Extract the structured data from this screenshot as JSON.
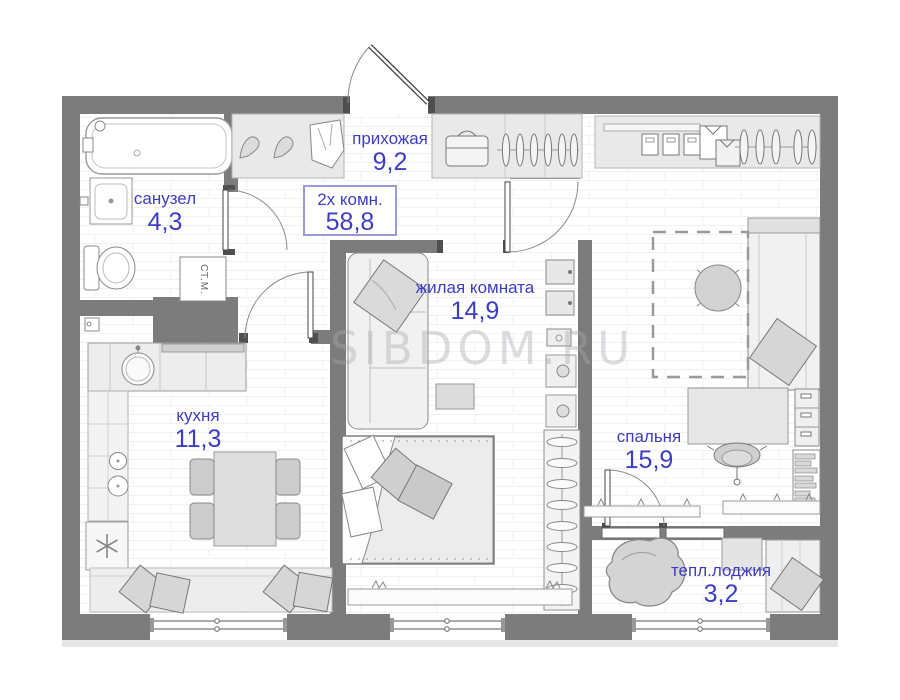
{
  "plan": {
    "type_label": "2х комн.",
    "total_area": "58,8",
    "watermark": "SIBDOM.RU",
    "rooms": [
      {
        "name": "прихожая",
        "area": "9,2"
      },
      {
        "name": "санузел",
        "area": "4,3"
      },
      {
        "name": "жилая комната",
        "area": "14,9"
      },
      {
        "name": "кухня",
        "area": "11,3"
      },
      {
        "name": "спальня",
        "area": "15,9"
      },
      {
        "name": "тепл.лоджия",
        "area": "3,2"
      }
    ],
    "appliance_labels": {
      "washing_machine": "СТ.М."
    },
    "colors": {
      "wall": "#7c7c7c",
      "label_blue": "#3d3dc4",
      "box_border": "#9a9ad8",
      "furniture_fill": "#e9e9e9",
      "watermark_gray": "#a9a9b2"
    }
  }
}
